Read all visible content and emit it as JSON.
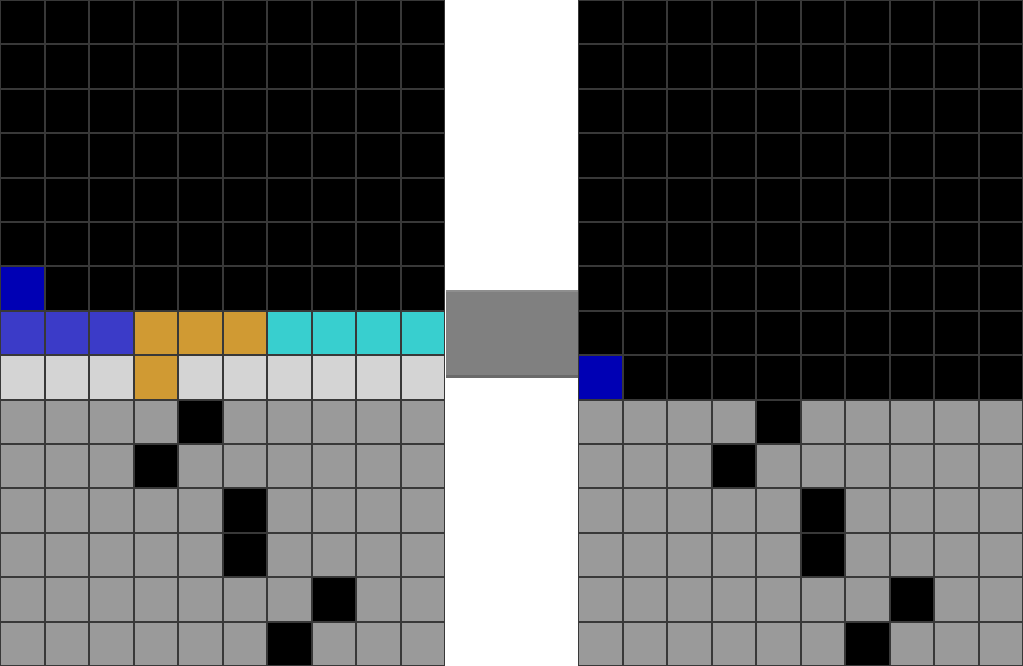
{
  "scene": {
    "description": "ARC-style puzzle: example input grid (left) and output grid (right) joined by a gray connector block",
    "canvas": {
      "width": 1023,
      "height": 666
    }
  },
  "colors": {
    "black": "#000000",
    "dark_blue": "#0000b4",
    "royal_blue": "#3b3bc8",
    "orange": "#d09a33",
    "cyan": "#38cfcf",
    "light_gray": "#d4d4d4",
    "gray": "#9a9a9a",
    "connector_gray": "#808080",
    "grid_line": "#383838",
    "gutter_white": "#ffffff"
  },
  "legend": {
    "k": "black",
    "b": "dark_blue",
    "B": "royal_blue",
    "o": "orange",
    "c": "cyan",
    "l": "light_gray",
    "g": "gray"
  },
  "left_grid": {
    "rows": 15,
    "cols": 10,
    "cells": [
      "kkkkkkkkkk",
      "kkkkkkkkkk",
      "kkkkkkkkkk",
      "kkkkkkkkkk",
      "kkkkkkkkkk",
      "kkkkkkkkkk",
      "bkkkkkkkkk",
      "BBBooocccc",
      "lllollllll",
      "ggggkggggg",
      "gggkgggggg",
      "gggggkgggg",
      "gggggkgggg",
      "gggggggkgg",
      "ggggggkggg"
    ]
  },
  "right_grid": {
    "rows": 15,
    "cols": 10,
    "cells": [
      "kkkkkkkkkk",
      "kkkkkkkkkk",
      "kkkkkkkkkk",
      "kkkkkkkkkk",
      "kkkkkkkkkk",
      "kkkkkkkkkk",
      "kkkkkkkkkk",
      "kkkkkkkkkk",
      "bkkkkkkkkk",
      "ggggkggggg",
      "gggkgggggg",
      "gggggkgggg",
      "gggggkgggg",
      "gggggggkgg",
      "ggggggkggg"
    ]
  },
  "connector": {
    "color_key": "connector_gray"
  }
}
